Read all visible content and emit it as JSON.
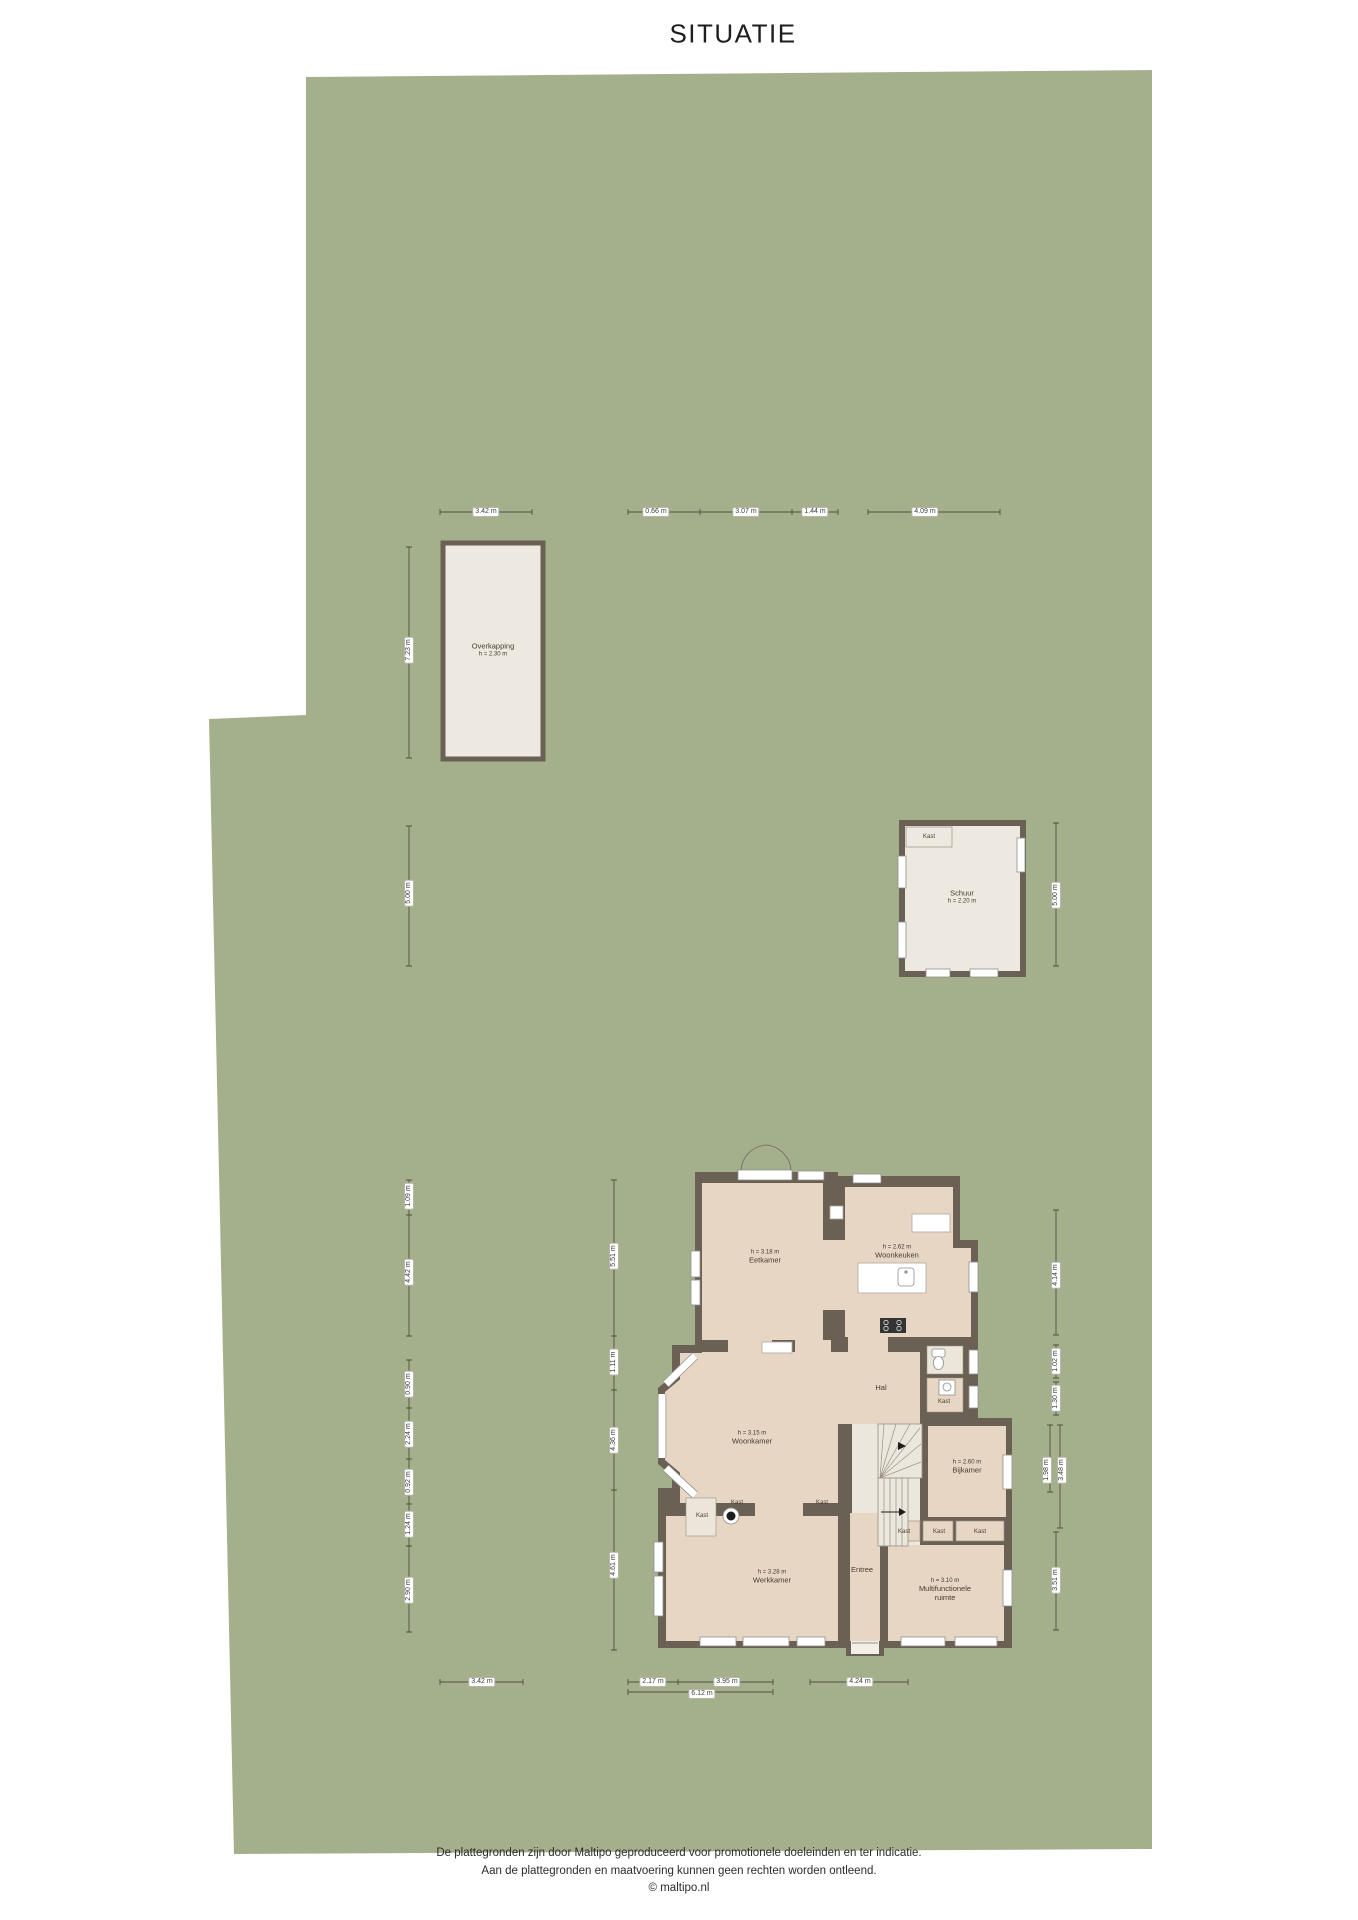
{
  "title": "SITUATIE",
  "site": {
    "overkapping": {
      "name": "Overkapping",
      "height": "h = 2.30 m"
    },
    "schuur": {
      "name": "Schuur",
      "height": "h = 2.20 m",
      "closet": "Kast"
    }
  },
  "house": {
    "eetkamer": {
      "height": "h = 3.18 m",
      "name": "Eetkamer"
    },
    "woonkeuken": {
      "height": "h = 2.62 m",
      "name": "Woonkeuken"
    },
    "woonkamer": {
      "height": "h = 3.15 m",
      "name": "Woonkamer"
    },
    "hal": {
      "name": "Hal"
    },
    "kast_hal": {
      "name": "Kast"
    },
    "bijkamer": {
      "height": "h = 2.60 m",
      "name": "Bijkamer"
    },
    "werkkamer": {
      "height": "h = 3.28 m",
      "name": "Werkkamer"
    },
    "entree": {
      "name": "Entree"
    },
    "multifunctioneel": {
      "height": "h = 3.10 m",
      "name": "Multifunctionele",
      "name2": "ruimte"
    },
    "kast_links": {
      "name": "Kast"
    },
    "kast_nis1": {
      "name": "Kast"
    },
    "kast_nis2": {
      "name": "Kast"
    },
    "kast_row1": {
      "name": "Kast"
    },
    "kast_row2": {
      "name": "Kast"
    },
    "kast_row3": {
      "name": "Kast"
    }
  },
  "dims": {
    "top": [
      "3.42 m",
      "0.66 m",
      "3.07 m",
      "1.44 m",
      "4.09 m"
    ],
    "left_outer": [
      "7.23 m",
      "5.00 m",
      "1.09 m",
      "4.42 m",
      "0.90 m",
      "2.24 m",
      "0.92 m",
      "1.24 m",
      "2.90 m"
    ],
    "left_inner": [
      "5.51 m",
      "1.11 m",
      "4.36 m",
      "4.61 m"
    ],
    "right": [
      "5.00 m",
      "4.14 m",
      "1.02 m",
      "1.30 m",
      "1.98 m",
      "3.48 m",
      "3.51 m"
    ],
    "bottom": [
      "3.42 m",
      "2.17 m",
      "3.95 m",
      "6.12 m",
      "4.24 m"
    ]
  },
  "footer": {
    "line1": "De plattegronden zijn door Maltipo geproduceerd voor promotionele doeleinden en ter indicatie.",
    "line2": "Aan de plattegronden en maatvoering kunnen geen rechten worden ontleend.",
    "line3": "© maltipo.nl"
  },
  "colors": {
    "plot": "#a4b08c",
    "wall": "#6b6054",
    "floor_tan": "#e6d6c3",
    "floor_light": "#ede9e0",
    "dim_line": "#4c5042"
  }
}
